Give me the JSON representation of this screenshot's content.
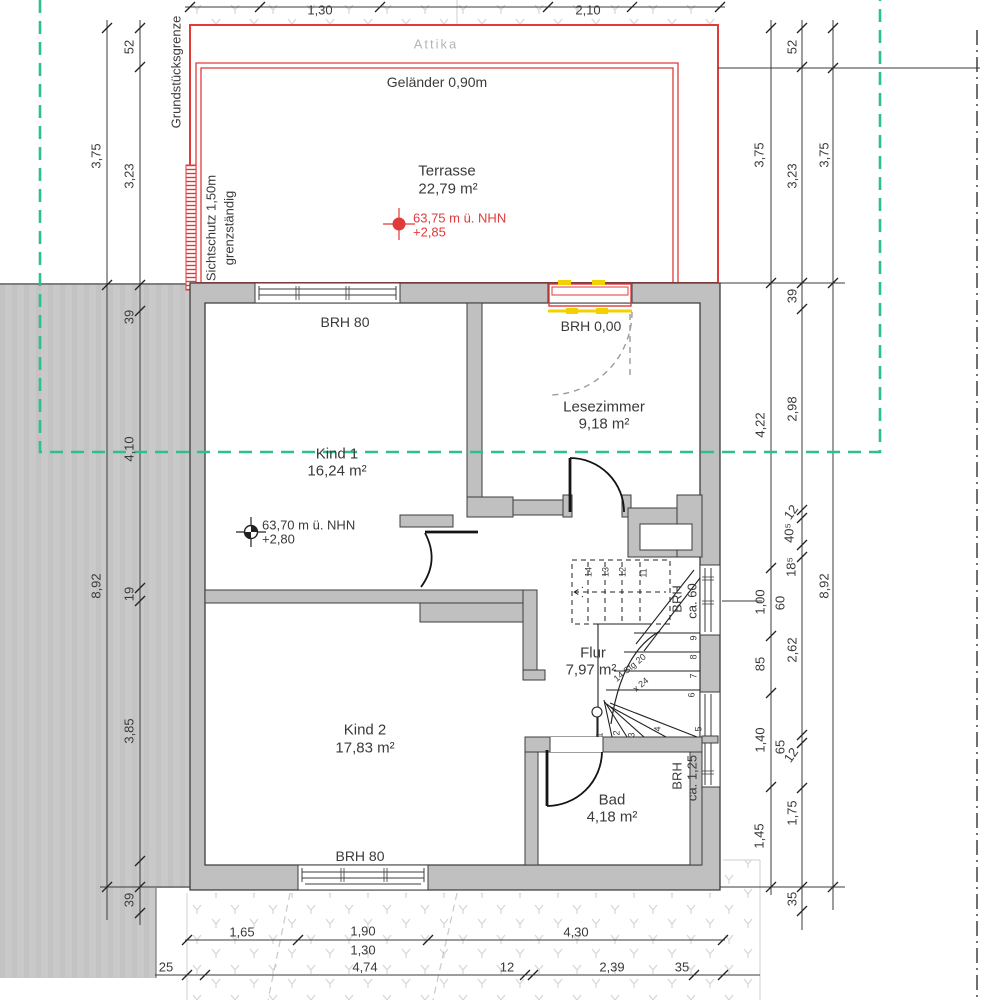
{
  "drawing": {
    "terrace": {
      "attika": "Attika",
      "railing": "Geländer 0,90m",
      "name": "Terrasse",
      "area": "22,79 m²",
      "elevation_line1": "63,75 m ü. NHN",
      "elevation_line2": "+2,85"
    },
    "site": {
      "property_line": "Grundstücksgrenze",
      "privacy_line1": "Sichtschutz 1,50m",
      "privacy_line2": "grenzständig"
    },
    "rooms": {
      "kind1": {
        "name": "Kind 1",
        "area": "16,24 m²"
      },
      "lesezimmer": {
        "name": "Lesezimmer",
        "area": "9,18 m²"
      },
      "flur": {
        "name": "Flur",
        "area": "7,97 m²"
      },
      "kind2": {
        "name": "Kind 2",
        "area": "17,83 m²"
      },
      "bad": {
        "name": "Bad",
        "area": "4,18 m²"
      }
    },
    "elevation_interior_line1": "63,70 m ü. NHN",
    "elevation_interior_line2": "+2,80",
    "sills": {
      "kind1_window": "BRH 80",
      "terrace_door": "BRH 0,00",
      "kind2_window": "BRH 80",
      "stair_window_line1": "BRH",
      "stair_window_line2": "ca. 60",
      "bad_window_line1": "BRH",
      "bad_window_line2": "ca. 1,25"
    },
    "stair_label_line1": "14 Stg 20",
    "stair_label_line2": "x 24"
  },
  "colors": {
    "wall_fill": "#c0c0c0",
    "wall_stroke": "#3d3d3d",
    "red": "#e03a3a",
    "yellow": "#f2d100",
    "green_dash": "#2fbe8f",
    "band_grey": "#c9c9c9",
    "pattern_grey": "#d8d8d8",
    "text": "#3a3a3a"
  },
  "dim_labels": [
    {
      "t": "1,30",
      "x": 320,
      "y": 10,
      "r": 0
    },
    {
      "t": "2,10",
      "x": 588,
      "y": 10,
      "r": 0
    },
    {
      "t": "3,75",
      "x": 96,
      "y": 156,
      "r": -90
    },
    {
      "t": "52",
      "x": 129,
      "y": 47,
      "r": -90
    },
    {
      "t": "3,23",
      "x": 129,
      "y": 176,
      "r": -90
    },
    {
      "t": "8,92",
      "x": 96,
      "y": 586,
      "r": -90
    },
    {
      "t": "39",
      "x": 129,
      "y": 317,
      "r": -90
    },
    {
      "t": "4,10",
      "x": 129,
      "y": 449,
      "r": -90
    },
    {
      "t": "19",
      "x": 129,
      "y": 594,
      "r": -90
    },
    {
      "t": "3,85",
      "x": 129,
      "y": 731,
      "r": -90
    },
    {
      "t": "39",
      "x": 129,
      "y": 900,
      "r": -90
    },
    {
      "t": "3,75",
      "x": 759,
      "y": 155,
      "r": -90
    },
    {
      "t": "4,22",
      "x": 760,
      "y": 425,
      "r": -90
    },
    {
      "t": "1,00",
      "x": 760,
      "y": 602,
      "r": -90
    },
    {
      "t": "85",
      "x": 760,
      "y": 664,
      "r": -90
    },
    {
      "t": "1,40",
      "x": 760,
      "y": 740,
      "r": -90
    },
    {
      "t": "1,45",
      "x": 759,
      "y": 836,
      "r": -90
    },
    {
      "t": "60",
      "x": 780,
      "y": 603,
      "r": -90
    },
    {
      "t": "65",
      "x": 780,
      "y": 747,
      "r": -90
    },
    {
      "t": "52",
      "x": 792,
      "y": 47,
      "r": -90
    },
    {
      "t": "3,23",
      "x": 792,
      "y": 176,
      "r": -90
    },
    {
      "t": "39",
      "x": 792,
      "y": 296,
      "r": -90
    },
    {
      "t": "2,98",
      "x": 792,
      "y": 409,
      "r": -90
    },
    {
      "t": "12",
      "x": 791,
      "y": 512,
      "r": -55
    },
    {
      "t": "40⁵",
      "x": 789,
      "y": 533,
      "r": -90
    },
    {
      "t": "18⁵",
      "x": 791,
      "y": 567,
      "r": -90
    },
    {
      "t": "2,62",
      "x": 792,
      "y": 650,
      "r": -90
    },
    {
      "t": "12",
      "x": 791,
      "y": 755,
      "r": -55
    },
    {
      "t": "1,75",
      "x": 792,
      "y": 813,
      "r": -90
    },
    {
      "t": "35",
      "x": 792,
      "y": 899,
      "r": -90
    },
    {
      "t": "3,75",
      "x": 824,
      "y": 155,
      "r": -90
    },
    {
      "t": "8,92",
      "x": 824,
      "y": 586,
      "r": -90
    },
    {
      "t": "1,65",
      "x": 242,
      "y": 932,
      "r": 0
    },
    {
      "t": "1,90",
      "x": 363,
      "y": 931,
      "r": 0
    },
    {
      "t": "1,30",
      "x": 363,
      "y": 950,
      "r": 0
    },
    {
      "t": "4,30",
      "x": 576,
      "y": 932,
      "r": 0
    },
    {
      "t": "25",
      "x": 166,
      "y": 967,
      "r": 0
    },
    {
      "t": "4,74",
      "x": 365,
      "y": 967,
      "r": 0
    },
    {
      "t": "12",
      "x": 507,
      "y": 967,
      "r": 0
    },
    {
      "t": "2,39",
      "x": 612,
      "y": 967,
      "r": 0
    },
    {
      "t": "35",
      "x": 682,
      "y": 967,
      "r": 0
    }
  ],
  "stair_numbers": [
    {
      "t": "14",
      "x": 589,
      "y": 572
    },
    {
      "t": "13",
      "x": 606,
      "y": 572
    },
    {
      "t": "12",
      "x": 623,
      "y": 572
    },
    {
      "t": "11",
      "x": 644,
      "y": 573
    },
    {
      "t": "9",
      "x": 694,
      "y": 638
    },
    {
      "t": "8",
      "x": 694,
      "y": 657
    },
    {
      "t": "7",
      "x": 694,
      "y": 676
    },
    {
      "t": "6",
      "x": 692,
      "y": 695
    },
    {
      "t": "5",
      "x": 699,
      "y": 729
    },
    {
      "t": "4",
      "x": 658,
      "y": 729
    },
    {
      "t": "3",
      "x": 632,
      "y": 735
    },
    {
      "t": "2",
      "x": 617,
      "y": 733
    },
    {
      "t": "1",
      "x": 600,
      "y": 735
    }
  ]
}
